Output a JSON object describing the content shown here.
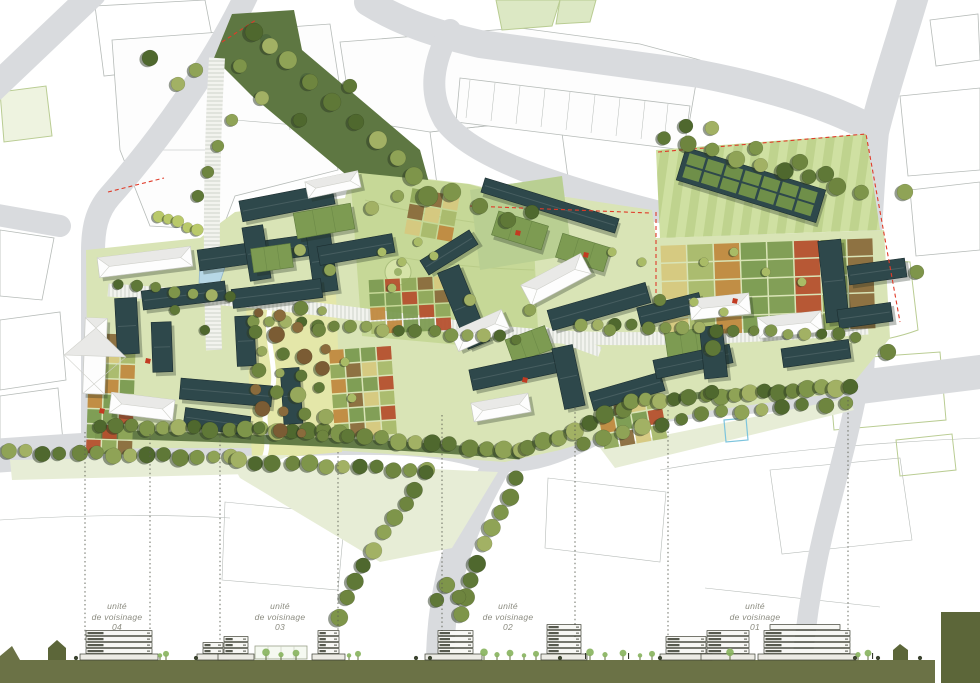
{
  "plan": {
    "title": "urban masterplan site plan",
    "unit_labels": [
      {
        "line1": "unité",
        "line2": "de voisinage",
        "number": "04"
      },
      {
        "line1": "unité",
        "line2": "de voisinage",
        "number": "03"
      },
      {
        "line1": "unité",
        "line2": "de voisinage",
        "number": "02"
      },
      {
        "line1": "unité",
        "line2": "de voisinage",
        "number": "01"
      }
    ]
  },
  "colors": {
    "background": "#ffffff",
    "road": "#d9dbde",
    "context_outline": "#b6bbb8",
    "context_green_outline": "#b9cc92",
    "site_base_green": "#d9e4b6",
    "meadow_green": "#c6d897",
    "lawn_stripe_a": "#cfe0a2",
    "lawn_stripe_b": "#bfd38e",
    "pale_verge": "#e7edd6",
    "orchard_ground": "#e4e7a9",
    "building_dark": "#2e484b",
    "building_dark_edge": "#1c2e30",
    "roof_white": "#fdfdfd",
    "roof_white_shade": "#e9e9e7",
    "roof_green": "#7d9b52",
    "tree_shadow": "#2c3a22",
    "tree_palette": [
      "#4f682e",
      "#5f7837",
      "#6e853f",
      "#7e954a",
      "#8fa356",
      "#a2b164"
    ],
    "orchard_palette": [
      "#7b5c34",
      "#8a6b3c",
      "#6e853f",
      "#97a85c",
      "#5f7837"
    ],
    "plot_palette": [
      "#8fa85a",
      "#a9b96b",
      "#7d9b52",
      "#8a6b3c",
      "#c0893f",
      "#b5502e",
      "#d6c87e",
      "#7a9a50"
    ],
    "boundary_red": "#e03a28",
    "water_blue": "#b7d8e6",
    "promenade_tick": "#c7cbc2",
    "section_ground": "#6b7246",
    "section_dark": "#5c6639",
    "section_line": "#3c3f33",
    "section_tree_green": "#86b35c",
    "cut_line": "#5a5d52",
    "label_text": "#8b8b80",
    "corridor_green": "#5e7742",
    "hedge_green": "#4d6834",
    "accent_red": "#c23b22"
  }
}
